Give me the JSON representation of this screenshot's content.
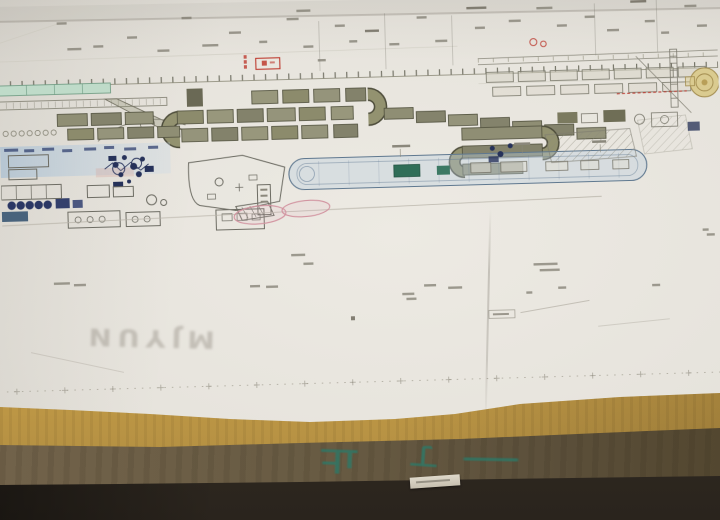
{
  "photo": {
    "watermark": "MJYUN",
    "stencil_marks": [
      {
        "glyph": "止"
      },
      {
        "glyph": "丁"
      },
      {
        "glyph": "一"
      }
    ],
    "colors": {
      "paper": "#e6e3dc",
      "machine_olive": "#93926f",
      "wash_blue": "#aec8dd",
      "navy_detail": "#2a3766",
      "accent_red": "#c23a2e",
      "accent_pink": "#d493a0",
      "mint_bar": "#bedbc9",
      "teal_station": "#2e6f58",
      "turntable_yellow": "#dbcb8e",
      "board_yellow": "#c79e49",
      "crate_brown": "#665942",
      "stencil_green": "#2c7a69",
      "floor_dark": "#2a241d"
    },
    "description": "Factory layout blueprint sheet lying on a yellow wooden board atop a brown crate"
  }
}
